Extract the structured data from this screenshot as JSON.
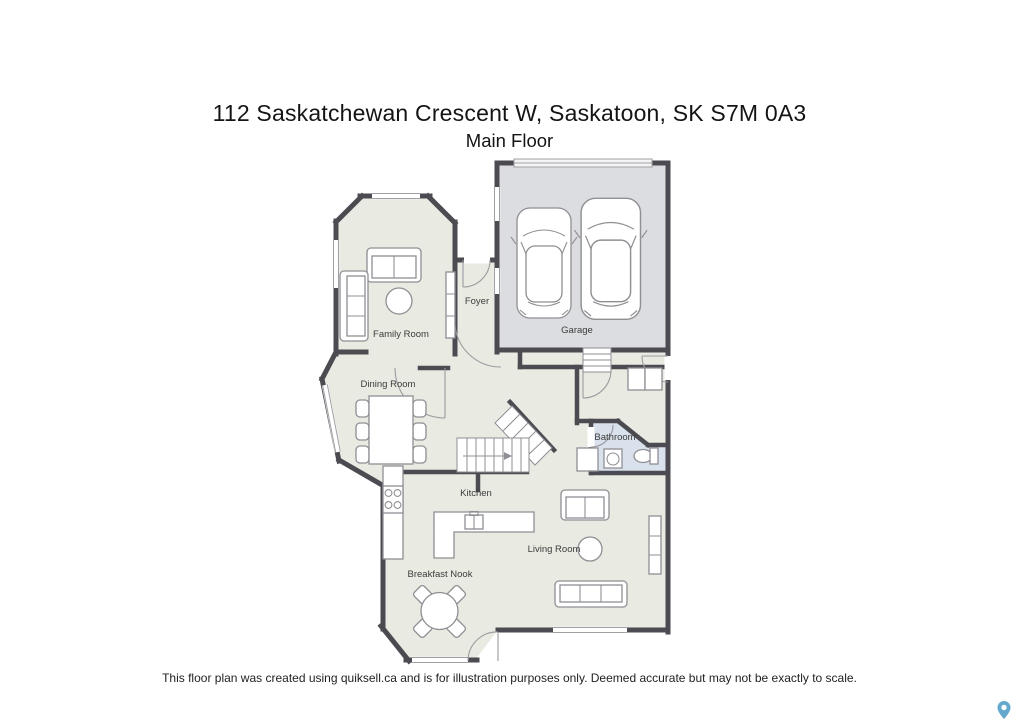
{
  "header": {
    "title": "112 Saskatchewan Crescent W, Saskatoon, SK S7M 0A3",
    "subtitle": "Main Floor"
  },
  "plan": {
    "rooms": [
      {
        "id": "foyer",
        "label": "Foyer"
      },
      {
        "id": "family-room",
        "label": "Family Room"
      },
      {
        "id": "garage",
        "label": "Garage"
      },
      {
        "id": "dining-room",
        "label": "Dining Room"
      },
      {
        "id": "bathroom",
        "label": "Bathroom"
      },
      {
        "id": "kitchen",
        "label": "Kitchen"
      },
      {
        "id": "living-room",
        "label": "Living Room"
      },
      {
        "id": "breakfast-nook",
        "label": "Breakfast Nook"
      }
    ],
    "colors": {
      "wall": "#4b4b51",
      "floor": "#e9eae2",
      "garage_floor": "#dcdde0",
      "bathroom_floor": "#d9e2ec",
      "furniture_line": "#8f8f94",
      "label_text": "#3c3c3c",
      "map_pin": "#64a9cd"
    },
    "icons": [
      "car-icon",
      "stairs-icon",
      "toilet-icon",
      "sink-icon",
      "stove-icon",
      "map-pin-icon"
    ]
  },
  "footer": {
    "disclaimer": "This floor plan was created using quiksell.ca and is for illustration purposes only. Deemed accurate but may not be exactly to scale."
  }
}
